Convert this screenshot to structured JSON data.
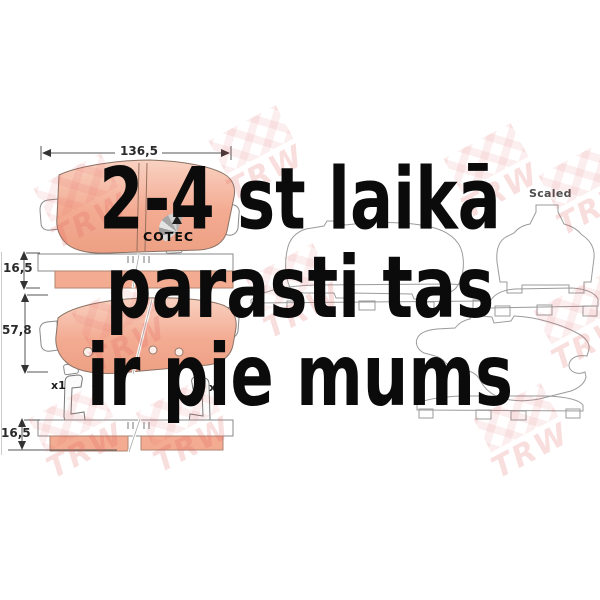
{
  "product_drawing": {
    "dimensions": {
      "pad_width": "136,5",
      "pad_thickness_top": "16,5",
      "pad_height": "57,8",
      "pad_thickness_bottom": "16,5"
    },
    "quantities": {
      "left_clip": "x1",
      "right_clip": "x1"
    },
    "scaled_label": "Scaled",
    "cotec_logo": "COTEC"
  },
  "overlay": {
    "lines": [
      "2-4 st laikā",
      "parasti tas",
      "ir pie mums"
    ],
    "color": "#0b0b0b"
  },
  "watermark": {
    "text": "TRW",
    "color": "#e25858"
  },
  "colors": {
    "background": "#ffffff",
    "friction_material": "#f2a88f",
    "friction_highlight": "#f9d2c2",
    "outline_gray": "#9b9b9b",
    "dimension_text": "#2a2a2a"
  }
}
